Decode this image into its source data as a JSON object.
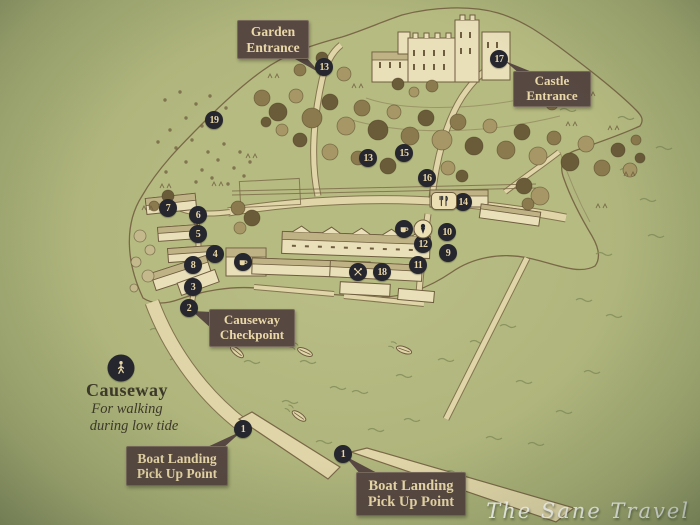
{
  "labels": {
    "garden_entrance": "Garden Entrance",
    "castle_entrance": "Castle Entrance",
    "causeway_checkpoint": "Causeway Checkpoint",
    "boat_landing_left": "Boat Landing Pick Up Point",
    "boat_landing_bottom": "Boat Landing Pick Up Point"
  },
  "causeway_note": {
    "title": "Causeway",
    "line1": "For walking",
    "line2": "during low tide"
  },
  "watermark": "The Sane Travel",
  "markers": [
    {
      "label": "1",
      "x": 243,
      "y": 429
    },
    {
      "label": "1",
      "x": 343,
      "y": 454
    },
    {
      "label": "2",
      "x": 189,
      "y": 308
    },
    {
      "label": "3",
      "x": 193,
      "y": 287
    },
    {
      "label": "4",
      "x": 215,
      "y": 254
    },
    {
      "label": "5",
      "x": 198,
      "y": 234
    },
    {
      "label": "6",
      "x": 198,
      "y": 215
    },
    {
      "label": "7",
      "x": 168,
      "y": 208
    },
    {
      "label": "8",
      "x": 193,
      "y": 265
    },
    {
      "label": "9",
      "x": 448,
      "y": 253
    },
    {
      "label": "10",
      "x": 447,
      "y": 232
    },
    {
      "label": "11",
      "x": 418,
      "y": 265
    },
    {
      "label": "12",
      "x": 423,
      "y": 244
    },
    {
      "label": "13",
      "x": 324,
      "y": 67
    },
    {
      "label": "13",
      "x": 368,
      "y": 158
    },
    {
      "label": "14",
      "x": 463,
      "y": 202
    },
    {
      "label": "15",
      "x": 404,
      "y": 153
    },
    {
      "label": "16",
      "x": 427,
      "y": 178
    },
    {
      "label": "17",
      "x": 499,
      "y": 59
    },
    {
      "label": "18",
      "x": 382,
      "y": 272
    },
    {
      "label": "19",
      "x": 214,
      "y": 120
    }
  ],
  "pois": [
    {
      "name": "walking-person",
      "x": 121,
      "y": 368,
      "variant": "dark-large"
    },
    {
      "name": "coffee-cup",
      "x": 243,
      "y": 262,
      "variant": "dark"
    },
    {
      "name": "coffee-cup",
      "x": 404,
      "y": 229,
      "variant": "dark"
    },
    {
      "name": "ice-cream-cone",
      "x": 423,
      "y": 229,
      "variant": "light"
    },
    {
      "name": "fork-and-knife",
      "x": 444,
      "y": 201,
      "variant": "light-rect"
    },
    {
      "name": "crossed-oars",
      "x": 358,
      "y": 272,
      "variant": "dark"
    }
  ],
  "colors": {
    "background_green": "#afb57c",
    "land_cream": "#e0d5a8",
    "ink_brown": "#6f5d3f",
    "label_bubble": "#574842",
    "label_text": "#ead8a8",
    "marker_bg": "#26262e",
    "marker_text": "#e8d6a6",
    "watermark_text": "#ffffff"
  }
}
